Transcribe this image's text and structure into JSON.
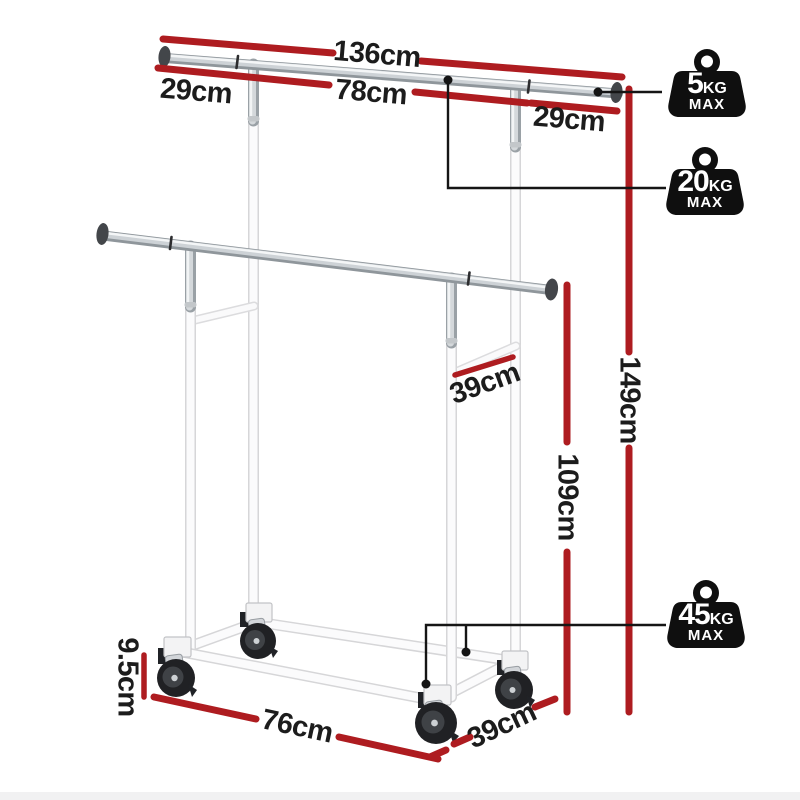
{
  "diagram": {
    "dimension_labels": [
      {
        "id": "top-total-width",
        "text": "136cm"
      },
      {
        "id": "left-arm-extension",
        "text": "29cm"
      },
      {
        "id": "center-rail-width",
        "text": "78cm"
      },
      {
        "id": "right-arm-extension",
        "text": "29cm"
      },
      {
        "id": "total-height",
        "text": "149cm"
      },
      {
        "id": "lower-rail-height",
        "text": "109cm"
      },
      {
        "id": "upper-depth",
        "text": "39cm"
      },
      {
        "id": "caster-height",
        "text": "9.5cm"
      },
      {
        "id": "base-width",
        "text": "76cm"
      },
      {
        "id": "base-depth",
        "text": "39cm"
      }
    ],
    "capacity_badges": [
      {
        "id": "top-rail-capacity",
        "icon": "weight-icon",
        "value": "5",
        "unit": "KG",
        "suffix": "MAX"
      },
      {
        "id": "lower-rail-capacity",
        "icon": "weight-icon",
        "value": "20",
        "unit": "KG",
        "suffix": "MAX"
      },
      {
        "id": "total-capacity",
        "icon": "weight-icon",
        "value": "45",
        "unit": "KG",
        "suffix": "MAX"
      }
    ],
    "colors": {
      "dimension_line": "#ae1c20",
      "label_text": "#1c1c1c",
      "badge_fill": "#0f0f0f",
      "badge_text": "#ffffff",
      "rack_white": "#fbfbfc",
      "rack_chrome": "#cdd2d6"
    }
  }
}
